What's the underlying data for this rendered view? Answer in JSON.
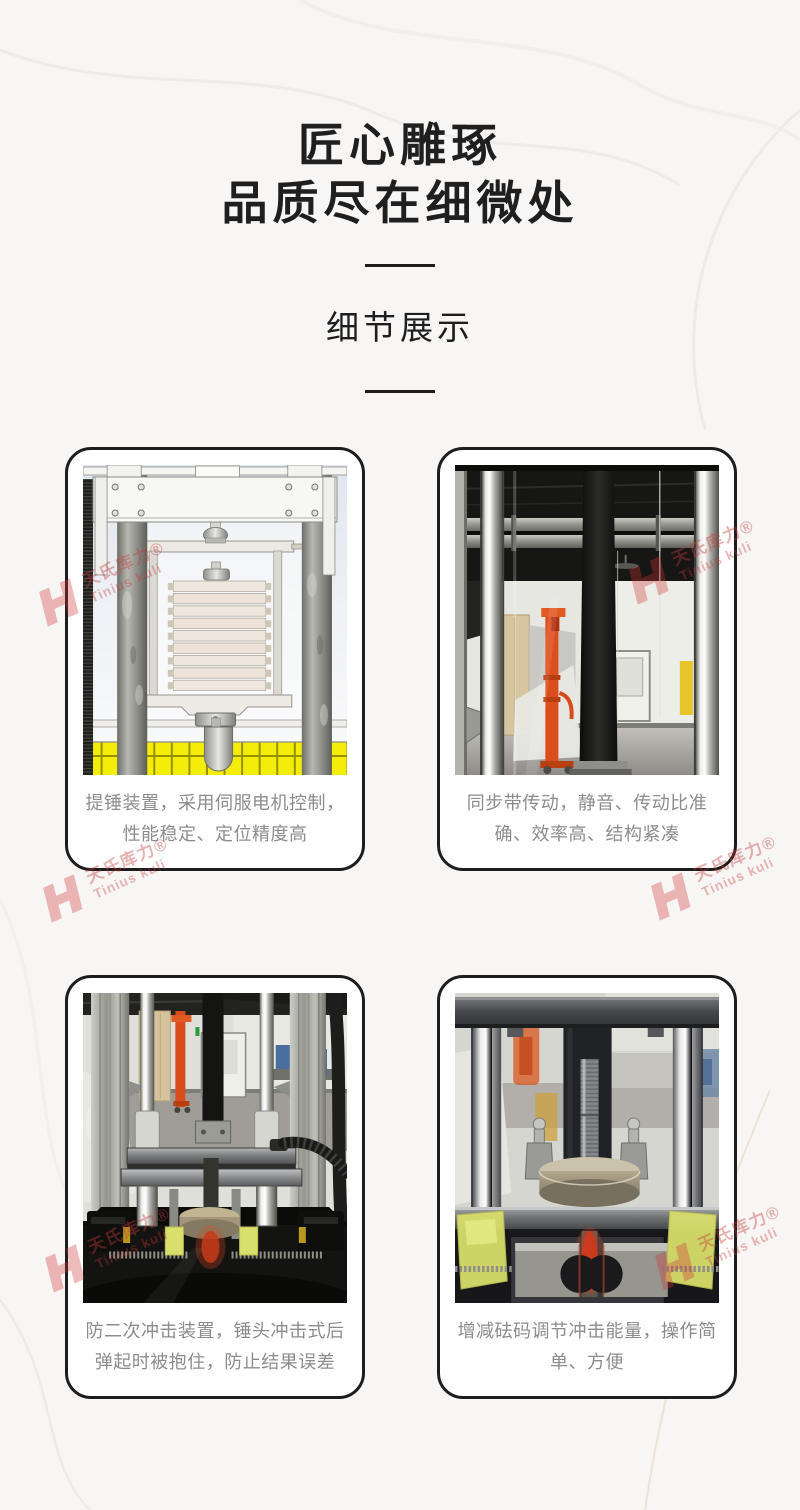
{
  "page": {
    "background_color": "#f7f6f5"
  },
  "header": {
    "title_line1": "匠心雕琢",
    "title_line2": "品质尽在细微处",
    "subtitle": "细节展示"
  },
  "watermark": {
    "brand_cn": "天氏库力®",
    "brand_en": "Tinius kuli",
    "color": "#c23b3b"
  },
  "cards": [
    {
      "photo": "servo-hammer-lift-cad-drawing",
      "caption": "提锤装置，采用伺服电机控制，性能稳定、定位精度高"
    },
    {
      "photo": "timing-belt-drive-photo",
      "caption": "同步带传动，静音、传动比准确、效率高、结构紧凑"
    },
    {
      "photo": "anti-secondary-impact-device-photo",
      "caption": "防二次冲击装置，锤头冲击式后弹起时被抱住，防止结果误差"
    },
    {
      "photo": "weight-adjustment-photo",
      "caption": "增减砝码调节冲击能量，操作简单、方便"
    }
  ]
}
